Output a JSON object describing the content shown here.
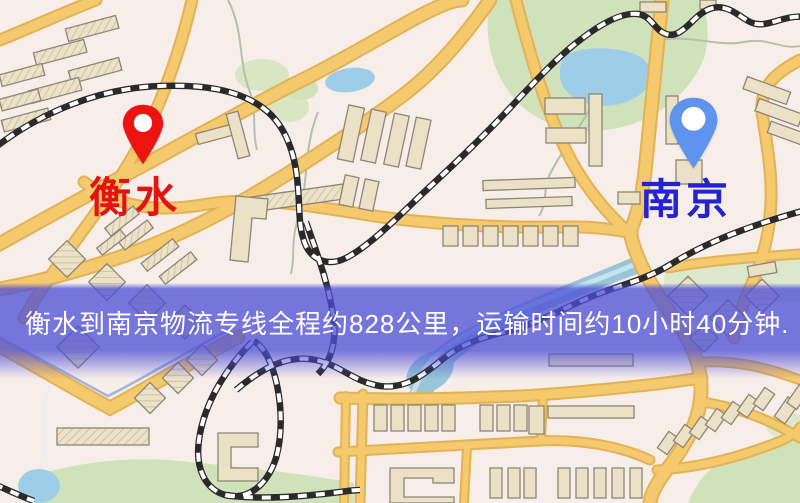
{
  "map": {
    "type": "road-map",
    "background_color": "#f7eeea",
    "road_color": "#f5c96d",
    "park_color": "#cfe2ba",
    "water_color": "#9ecde8",
    "railway_color": "#2a2a2a",
    "markers": [
      {
        "id": "hengshui",
        "label": "衡水",
        "pin_color": "#ec1310",
        "label_color": "#e01511",
        "side": "left"
      },
      {
        "id": "nanjing",
        "label": "南京",
        "pin_color": "#5e93ee",
        "label_color": "#2323cf",
        "side": "right"
      }
    ]
  },
  "route": {
    "origin": "衡水",
    "destination": "南京",
    "distance_text": "约828公里",
    "duration_text": "约10小时40分钟"
  },
  "caption": {
    "text": "衡水到南京物流专线全程约828公里，运输时间约10小时40分钟.",
    "background_color": "#4d4fd6",
    "text_color": "#ffffff"
  }
}
